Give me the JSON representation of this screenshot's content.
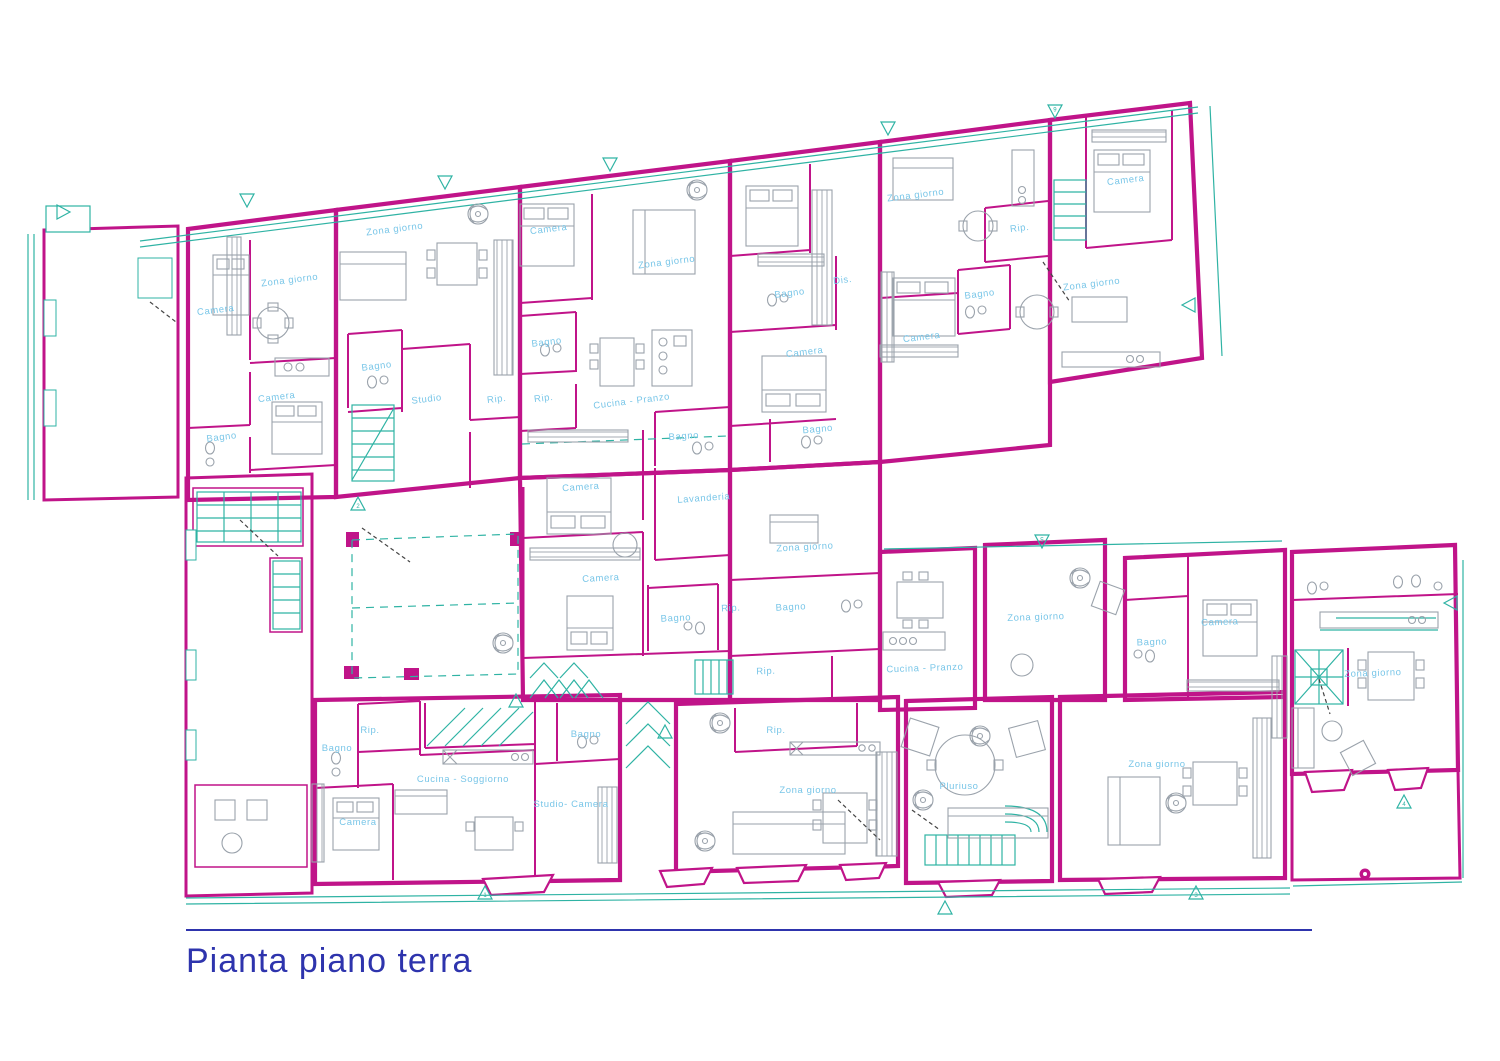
{
  "title": {
    "text": "Pianta piano terra"
  },
  "colors": {
    "wall": "#c01489",
    "fixture_teal": "#2fb3a4",
    "furniture_gray": "#9aa2ab",
    "room_label_blue": "#79c6e8",
    "title_blue": "#2e34ad",
    "hatch_line": "#a3968e",
    "door_dash": "#444444",
    "background": "#ffffff"
  },
  "rooms": [
    {
      "label": "Camera",
      "x": 216,
      "y": 313,
      "r": -7
    },
    {
      "label": "Zona giorno",
      "x": 290,
      "y": 283,
      "r": -7
    },
    {
      "label": "Camera",
      "x": 277,
      "y": 400,
      "r": -7
    },
    {
      "label": "Bagno",
      "x": 222,
      "y": 440,
      "r": -7
    },
    {
      "label": "Zona giorno",
      "x": 395,
      "y": 232,
      "r": -7
    },
    {
      "label": "Bagno",
      "x": 377,
      "y": 369,
      "r": -7
    },
    {
      "label": "Studio",
      "x": 427,
      "y": 402,
      "r": -7
    },
    {
      "label": "Rip.",
      "x": 497,
      "y": 402,
      "r": -7
    },
    {
      "label": "Camera",
      "x": 549,
      "y": 232,
      "r": -7
    },
    {
      "label": "Zona giorno",
      "x": 667,
      "y": 265,
      "r": -7
    },
    {
      "label": "Bagno",
      "x": 547,
      "y": 345,
      "r": -7
    },
    {
      "label": "Rip.",
      "x": 544,
      "y": 401,
      "r": -7
    },
    {
      "label": "Cucina - Pranzo",
      "x": 632,
      "y": 404,
      "r": -7
    },
    {
      "label": "Bagno",
      "x": 684,
      "y": 439,
      "r": -4
    },
    {
      "label": "Camera",
      "x": 581,
      "y": 490,
      "r": -4
    },
    {
      "label": "Lavanderia",
      "x": 704,
      "y": 501,
      "r": -4
    },
    {
      "label": "Camera",
      "x": 601,
      "y": 581,
      "r": -3
    },
    {
      "label": "Bagno",
      "x": 676,
      "y": 621,
      "r": -3
    },
    {
      "label": "Rip.",
      "x": 731,
      "y": 611,
      "r": -3
    },
    {
      "label": "Bagno",
      "x": 790,
      "y": 296,
      "r": -7
    },
    {
      "label": "Dis.",
      "x": 843,
      "y": 283,
      "r": -7
    },
    {
      "label": "Camera",
      "x": 805,
      "y": 355,
      "r": -7
    },
    {
      "label": "Bagno",
      "x": 818,
      "y": 432,
      "r": -5
    },
    {
      "label": "Zona giorno",
      "x": 805,
      "y": 550,
      "r": -3
    },
    {
      "label": "Bagno",
      "x": 791,
      "y": 610,
      "r": -3
    },
    {
      "label": "Rip.",
      "x": 766,
      "y": 674,
      "r": -2
    },
    {
      "label": "Zona giorno",
      "x": 916,
      "y": 198,
      "r": -7
    },
    {
      "label": "Bagno",
      "x": 980,
      "y": 297,
      "r": -7
    },
    {
      "label": "Rip.",
      "x": 1020,
      "y": 231,
      "r": -7
    },
    {
      "label": "Camera",
      "x": 922,
      "y": 340,
      "r": -7
    },
    {
      "label": "Camera",
      "x": 1126,
      "y": 183,
      "r": -7
    },
    {
      "label": "Zona giorno",
      "x": 1092,
      "y": 287,
      "r": -7
    },
    {
      "label": "Cucina - Pranzo",
      "x": 925,
      "y": 671,
      "r": -2
    },
    {
      "label": "Zona giorno",
      "x": 1036,
      "y": 620,
      "r": -2
    },
    {
      "label": "Bagno",
      "x": 1152,
      "y": 645,
      "r": -2
    },
    {
      "label": "Camera",
      "x": 1220,
      "y": 625,
      "r": -2
    },
    {
      "label": "Zona giorno",
      "x": 1373,
      "y": 676,
      "r": -2
    },
    {
      "label": "Rip.",
      "x": 370,
      "y": 733,
      "r": 0
    },
    {
      "label": "Bagno",
      "x": 337,
      "y": 751,
      "r": 0
    },
    {
      "label": "Camera",
      "x": 358,
      "y": 825,
      "r": 0
    },
    {
      "label": "Cucina - Soggiorno",
      "x": 463,
      "y": 782,
      "r": 0
    },
    {
      "label": "Bagno",
      "x": 586,
      "y": 737,
      "r": 0
    },
    {
      "label": "Studio- Camera",
      "x": 571,
      "y": 807,
      "r": 0
    },
    {
      "label": "Rip.",
      "x": 776,
      "y": 733,
      "r": 0
    },
    {
      "label": "Zona giorno",
      "x": 808,
      "y": 793,
      "r": 0
    },
    {
      "label": "Pluriuso",
      "x": 959,
      "y": 789,
      "r": 0
    },
    {
      "label": "Zona giorno",
      "x": 1157,
      "y": 767,
      "r": 0
    }
  ],
  "markers": [
    {
      "x": 247,
      "y": 199,
      "rot": 180,
      "n": ""
    },
    {
      "x": 445,
      "y": 181,
      "rot": 180,
      "n": ""
    },
    {
      "x": 610,
      "y": 163,
      "rot": 180,
      "n": ""
    },
    {
      "x": 888,
      "y": 127,
      "rot": 180,
      "n": ""
    },
    {
      "x": 1055,
      "y": 110,
      "rot": 180,
      "n": "6"
    },
    {
      "x": 1042,
      "y": 540,
      "rot": 180,
      "n": "5"
    },
    {
      "x": 62,
      "y": 212,
      "rot": 90,
      "n": ""
    },
    {
      "x": 358,
      "y": 505,
      "rot": 0,
      "n": "2"
    },
    {
      "x": 516,
      "y": 702,
      "rot": 0,
      "n": ""
    },
    {
      "x": 485,
      "y": 894,
      "rot": 0,
      "n": "1"
    },
    {
      "x": 945,
      "y": 909,
      "rot": 0,
      "n": ""
    },
    {
      "x": 1196,
      "y": 894,
      "rot": 0,
      "n": "3"
    },
    {
      "x": 1404,
      "y": 803,
      "rot": 0,
      "n": "4"
    },
    {
      "x": 665,
      "y": 733,
      "rot": 0,
      "n": ""
    },
    {
      "x": 1190,
      "y": 305,
      "rot": 270,
      "n": ""
    },
    {
      "x": 1452,
      "y": 603,
      "rot": 270,
      "n": ""
    }
  ],
  "fans": [
    {
      "x": 478,
      "y": 214
    },
    {
      "x": 697,
      "y": 190
    },
    {
      "x": 503,
      "y": 643
    },
    {
      "x": 720,
      "y": 723
    },
    {
      "x": 705,
      "y": 841
    },
    {
      "x": 923,
      "y": 800
    },
    {
      "x": 980,
      "y": 736
    },
    {
      "x": 1080,
      "y": 578
    },
    {
      "x": 1176,
      "y": 803
    }
  ]
}
